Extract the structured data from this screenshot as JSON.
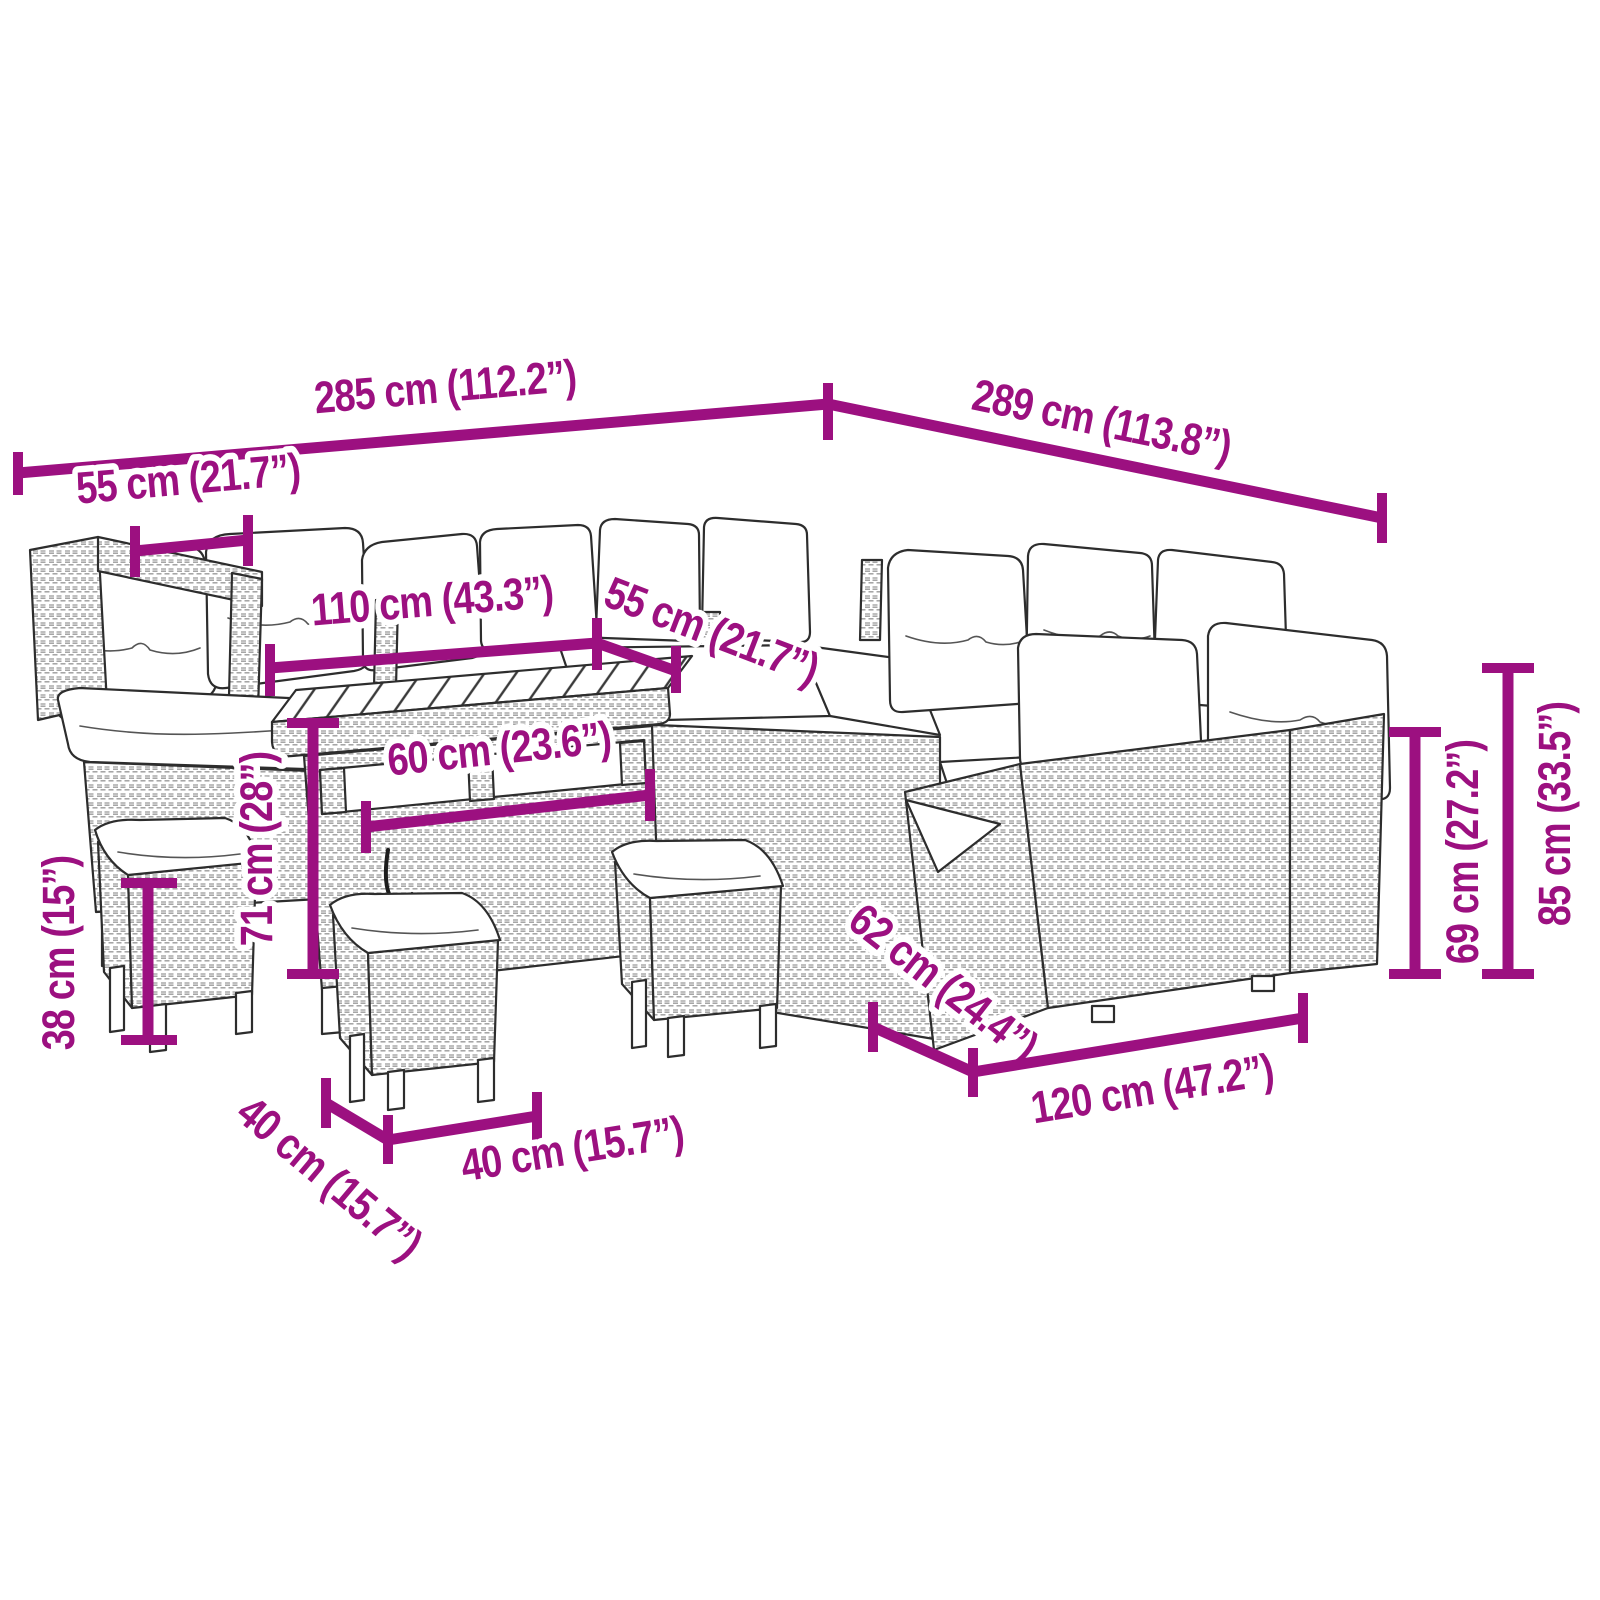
{
  "diagram": {
    "type": "product-dimension-diagram",
    "product": "poly rattan garden lounge set with corner sofa, dining table and stools",
    "accent_color": "#9C1080",
    "artwork_line_color": "#2D2D2D",
    "background_color": "#FFFFFF",
    "dimensions": [
      {
        "id": "overall-width",
        "label": "285 cm (112.2”)"
      },
      {
        "id": "overall-depth",
        "label": "289 cm (113.8”)"
      },
      {
        "id": "armrest-module-width",
        "label": "55 cm (21.7”)"
      },
      {
        "id": "table-length",
        "label": "110 cm (43.3”)"
      },
      {
        "id": "seat-module-width",
        "label": "55 cm (21.7”)"
      },
      {
        "id": "table-depth",
        "label": "60 cm (23.6”)"
      },
      {
        "id": "table-height",
        "label": "71 cm (28”)"
      },
      {
        "id": "stool-height",
        "label": "38 cm (15”)"
      },
      {
        "id": "stool-depth",
        "label": "40 cm (15.7”)"
      },
      {
        "id": "stool-width",
        "label": "40 cm (15.7”)"
      },
      {
        "id": "sofa-depth",
        "label": "62 cm (24.4”)"
      },
      {
        "id": "sofa-module-width",
        "label": "120 cm (47.2”)"
      },
      {
        "id": "backrest-height",
        "label": "69 cm (27.2”)"
      },
      {
        "id": "total-height",
        "label": "85 cm (33.5”)"
      }
    ]
  }
}
